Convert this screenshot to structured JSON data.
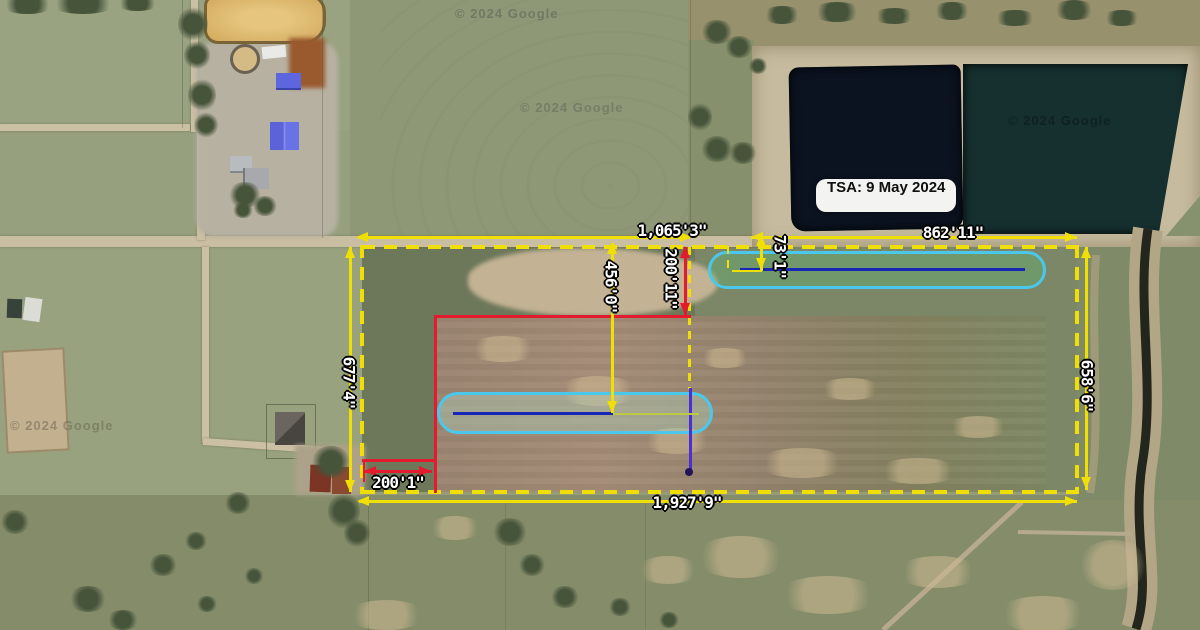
{
  "scene": {
    "type": "satellite-map-measurement-overlay",
    "timestamp_label": "TSA: 9 May 2024",
    "attribution": "© 2024 Google"
  },
  "measurements": {
    "north_west_segment": "1,065'3\"",
    "north_gap": "73'1\"",
    "north_east_segment": "862'11\"",
    "west_side": "677'4\"",
    "east_side": "658'6\"",
    "south_side": "1,927'9\"",
    "interior_vertical": "456'0\"",
    "red_vertical": "200'11\"",
    "red_horizontal": "200'1\""
  },
  "colors": {
    "dimension_yellow": "#f0df05",
    "parcel_red": "#e41b2c",
    "runway_outline_cyan": "#4cc7ec",
    "runway_centerline_blue": "#1726b5",
    "marker_purple": "#4b2fd4",
    "pond_west": "#0b1320",
    "pond_east": "#163030"
  }
}
